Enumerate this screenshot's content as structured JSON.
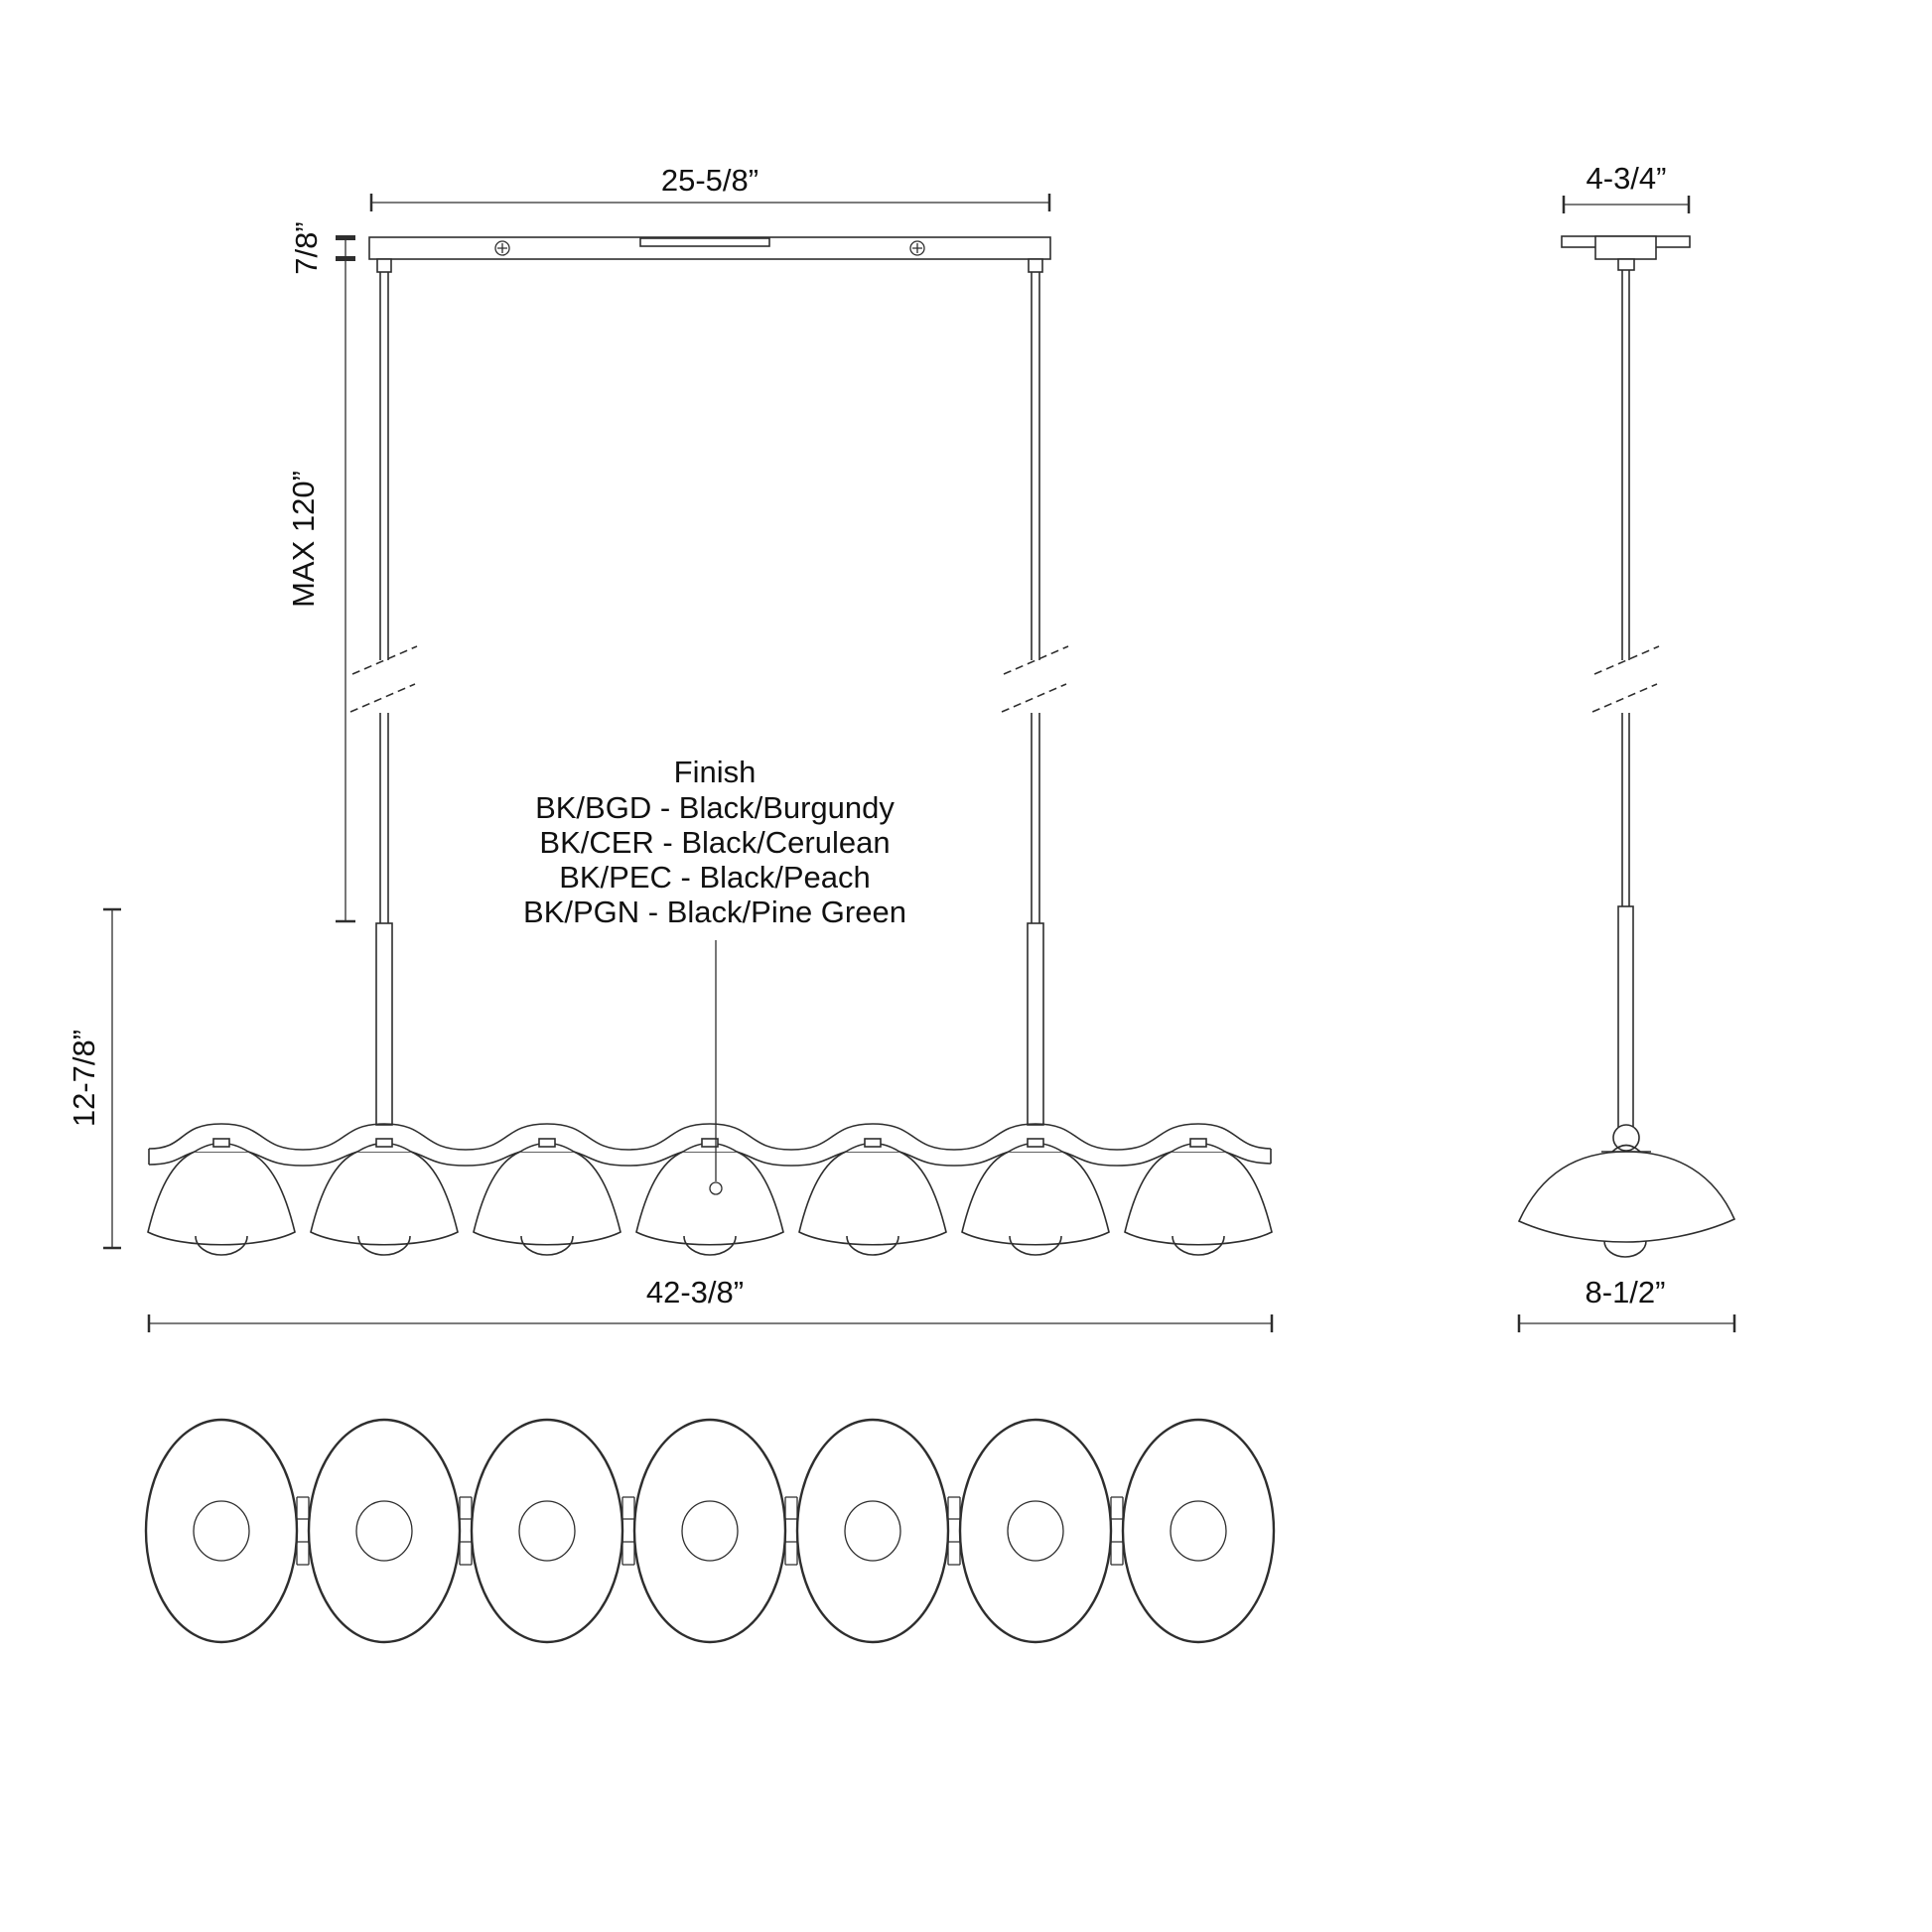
{
  "colors": {
    "line": "#2e2e2e",
    "text": "#111111",
    "background": "#ffffff"
  },
  "front_view": {
    "canopy_width_label": "25-5/8”",
    "canopy_height_label": "7/8”",
    "max_suspension_label": "MAX 120”",
    "fixture_height_label": "12-7/8”",
    "fixture_width_label": "42-3/8”"
  },
  "side_view": {
    "canopy_depth_label": "4-3/4”",
    "shade_diameter_label": "8-1/2”"
  },
  "finish_legend": {
    "title": "Finish",
    "options": [
      "BK/BGD - Black/Burgundy",
      "BK/CER - Black/Cerulean",
      "BK/PEC - Black/Peach",
      "BK/PGN - Black/Pine Green"
    ]
  }
}
